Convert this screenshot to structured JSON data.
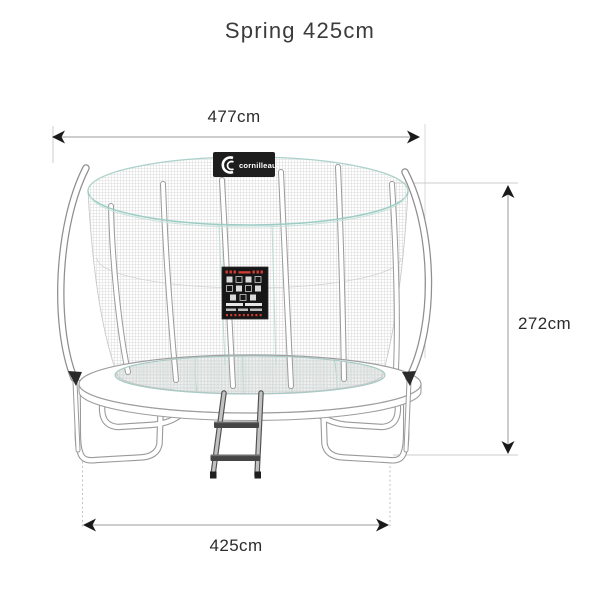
{
  "title": "Spring 425cm",
  "product": {
    "name": "Spring 425cm trampoline with safety enclosure",
    "brand_logo_text": "cornilleau"
  },
  "dimensions": {
    "top_width_label": "477cm",
    "height_label": "272cm",
    "base_width_label": "425cm"
  },
  "colors": {
    "accent_teal": "#9ccdc5",
    "seam_teal": "#b9dcd5",
    "dimension_line": "#9b9b9b",
    "extension_line": "#cccccc",
    "arrow": "#1a1a1a",
    "text": "#2c2c2c",
    "badge_bg": "#1d1d1d",
    "placard_bg": "#161616",
    "placard_red": "#d43d33"
  }
}
